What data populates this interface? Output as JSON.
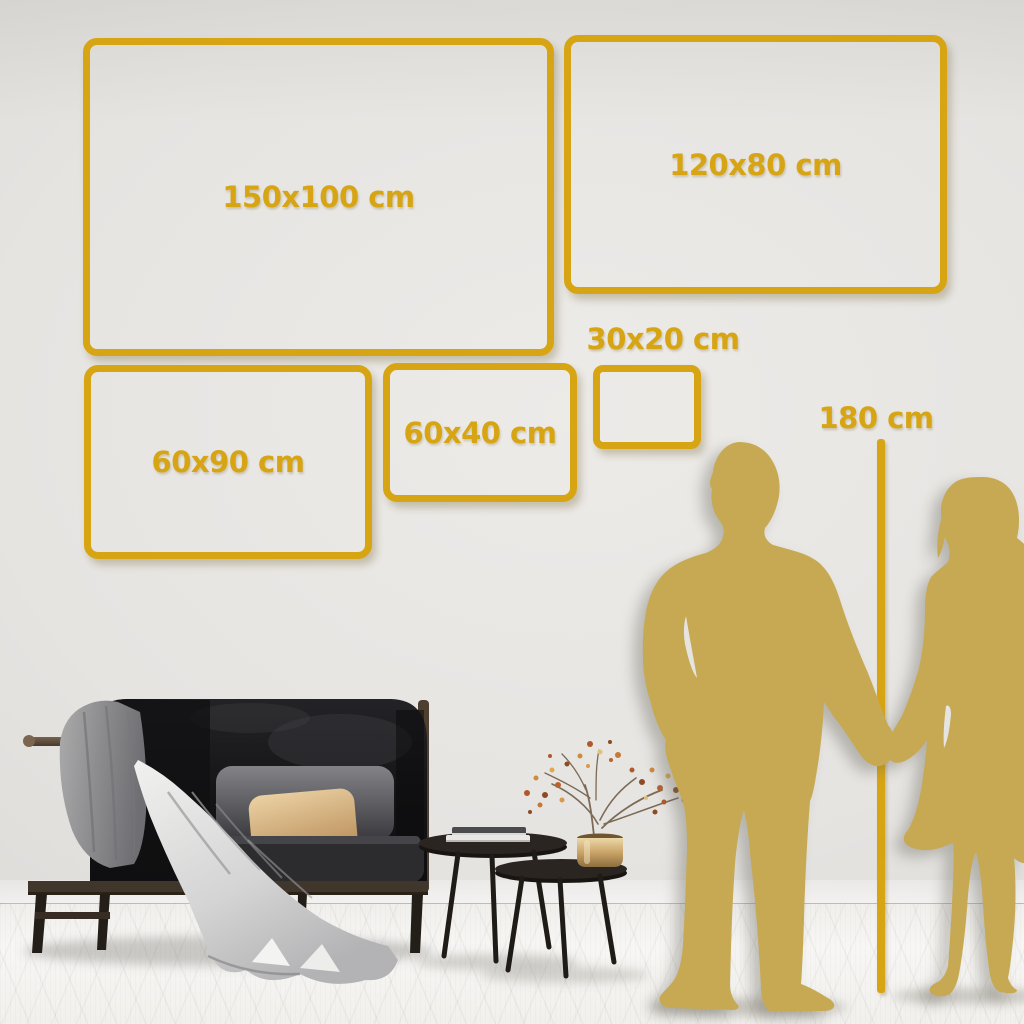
{
  "scene": {
    "description": "Wall-art size comparison guide: gold outline frames on a living-room wall with sofa, nesting tables and a couple silhouette height reference",
    "colors": {
      "accent_gold": "#D7A413",
      "silhouette_gold": "#C6A952",
      "wall": "#E4E2DF",
      "floor": "#F3F2F0"
    },
    "size_frames": [
      {
        "id": "150x100",
        "label": "150x100 cm"
      },
      {
        "id": "120x80",
        "label": "120x80 cm"
      },
      {
        "id": "60x90",
        "label": "60x90 cm"
      },
      {
        "id": "60x40",
        "label": "60x40 cm"
      },
      {
        "id": "30x20",
        "label": "30x20 cm"
      }
    ],
    "height_gauge": {
      "label": "180 cm"
    }
  }
}
